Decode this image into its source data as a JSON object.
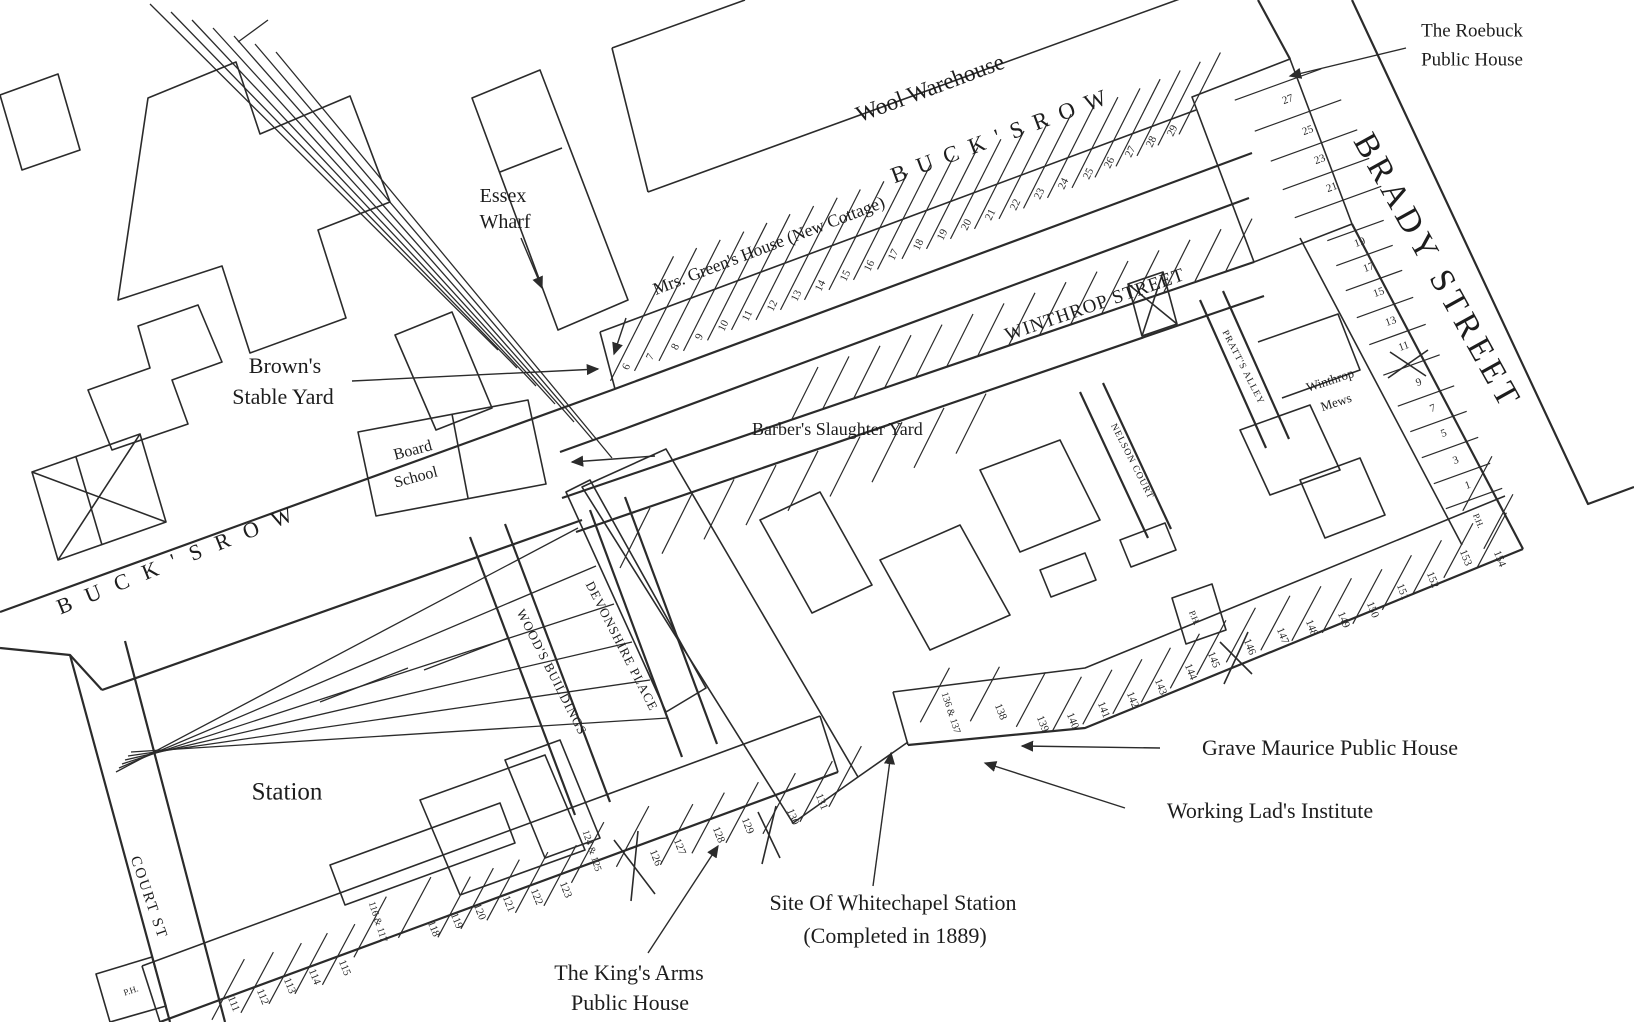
{
  "labels": {
    "wool_warehouse": "Wool Warehouse",
    "bucks_row_north": "B U C K ' S   R O W",
    "mrs_greens_house": "Mrs. Green's House (New Cottage)",
    "roebuck_line1": "The Roebuck",
    "roebuck_line2": "Public House",
    "brady_street": "BRADY STREET",
    "essex_wharf_line1": "Essex",
    "essex_wharf_line2": "Wharf",
    "browns_line1": "Brown's",
    "browns_line2": "Stable Yard",
    "board_school_line1": "Board",
    "board_school_line2": "School",
    "barbers_yard": "Barber's Slaughter Yard",
    "winthrop_street": "WINTHROP STREET",
    "pratts_alley": "PRATT'S ALLEY",
    "nelson_court": "NELSON COURT",
    "winthrop_mews_line1": "Winthrop",
    "winthrop_mews_line2": "Mews",
    "bucks_row_west": "B U C K ' S   R O W",
    "court_st": "COURT ST",
    "station": "Station",
    "woods_buildings": "WOOD'S BUILDINGS",
    "devonshire_place": "DEVONSHIRE PLACE",
    "grave_maurice": "Grave Maurice Public House",
    "working_lads": "Working Lad's Institute",
    "whitechapel_station_line1": "Site Of Whitechapel Station",
    "whitechapel_station_line2": "(Completed in 1889)",
    "kings_arms_line1": "The King's Arms",
    "kings_arms_line2": "Public House"
  },
  "house_numbers": [
    {
      "t": "6",
      "x": 627,
      "y": 367,
      "r": -64,
      "s": 11
    },
    {
      "t": "7",
      "x": 651,
      "y": 357,
      "r": -64,
      "s": 11
    },
    {
      "t": "8",
      "x": 676,
      "y": 347,
      "r": -64,
      "s": 11
    },
    {
      "t": "9",
      "x": 700,
      "y": 337,
      "r": -64,
      "s": 11
    },
    {
      "t": "10",
      "x": 724,
      "y": 326,
      "r": -64,
      "s": 11
    },
    {
      "t": "11",
      "x": 748,
      "y": 316,
      "r": -64,
      "s": 11
    },
    {
      "t": "12",
      "x": 773,
      "y": 306,
      "r": -64,
      "s": 11
    },
    {
      "t": "13",
      "x": 797,
      "y": 296,
      "r": -64,
      "s": 11
    },
    {
      "t": "14",
      "x": 821,
      "y": 286,
      "r": -64,
      "s": 11
    },
    {
      "t": "15",
      "x": 846,
      "y": 276,
      "r": -64,
      "s": 11
    },
    {
      "t": "16",
      "x": 870,
      "y": 266,
      "r": -64,
      "s": 11
    },
    {
      "t": "17",
      "x": 894,
      "y": 255,
      "r": -64,
      "s": 11
    },
    {
      "t": "18",
      "x": 919,
      "y": 245,
      "r": -64,
      "s": 11
    },
    {
      "t": "19",
      "x": 943,
      "y": 235,
      "r": -64,
      "s": 11
    },
    {
      "t": "20",
      "x": 967,
      "y": 225,
      "r": -64,
      "s": 11
    },
    {
      "t": "21",
      "x": 991,
      "y": 215,
      "r": -64,
      "s": 11
    },
    {
      "t": "22",
      "x": 1016,
      "y": 205,
      "r": -64,
      "s": 11
    },
    {
      "t": "23",
      "x": 1040,
      "y": 194,
      "r": -64,
      "s": 11
    },
    {
      "t": "24",
      "x": 1064,
      "y": 184,
      "r": -64,
      "s": 11
    },
    {
      "t": "25",
      "x": 1089,
      "y": 174,
      "r": -64,
      "s": 11
    },
    {
      "t": "26",
      "x": 1110,
      "y": 163,
      "r": -64,
      "s": 11
    },
    {
      "t": "27",
      "x": 1131,
      "y": 152,
      "r": -64,
      "s": 11
    },
    {
      "t": "28",
      "x": 1152,
      "y": 142,
      "r": -64,
      "s": 11
    },
    {
      "t": "29",
      "x": 1173,
      "y": 131,
      "r": -64,
      "s": 11
    },
    {
      "t": "27",
      "x": 1288,
      "y": 100,
      "r": -20,
      "s": 11
    },
    {
      "t": "25",
      "x": 1308,
      "y": 131,
      "r": -20,
      "s": 11
    },
    {
      "t": "23",
      "x": 1320,
      "y": 160,
      "r": -20,
      "s": 11
    },
    {
      "t": "21",
      "x": 1332,
      "y": 188,
      "r": -20,
      "s": 11
    },
    {
      "t": "19",
      "x": 1360,
      "y": 243,
      "r": -20,
      "s": 11
    },
    {
      "t": "17",
      "x": 1369,
      "y": 268,
      "r": -20,
      "s": 11
    },
    {
      "t": "15",
      "x": 1379,
      "y": 293,
      "r": -20,
      "s": 11
    },
    {
      "t": "13",
      "x": 1391,
      "y": 322,
      "r": -20,
      "s": 11
    },
    {
      "t": "11",
      "x": 1404,
      "y": 347,
      "r": -20,
      "s": 11
    },
    {
      "t": "9",
      "x": 1419,
      "y": 383,
      "r": -20,
      "s": 11
    },
    {
      "t": "7",
      "x": 1433,
      "y": 409,
      "r": -20,
      "s": 11
    },
    {
      "t": "5",
      "x": 1444,
      "y": 434,
      "r": -20,
      "s": 11
    },
    {
      "t": "3",
      "x": 1456,
      "y": 461,
      "r": -20,
      "s": 11
    },
    {
      "t": "1",
      "x": 1468,
      "y": 486,
      "r": -20,
      "s": 11
    },
    {
      "t": "P.H.",
      "x": 1478,
      "y": 521,
      "r": 68,
      "s": 9
    },
    {
      "t": "154",
      "x": 1499,
      "y": 559,
      "r": 68,
      "s": 11
    },
    {
      "t": "153",
      "x": 1465,
      "y": 558,
      "r": 68,
      "s": 11
    },
    {
      "t": "152",
      "x": 1432,
      "y": 580,
      "r": 68,
      "s": 11
    },
    {
      "t": "151",
      "x": 1402,
      "y": 592,
      "r": 68,
      "s": 11
    },
    {
      "t": "150",
      "x": 1372,
      "y": 610,
      "r": 68,
      "s": 11
    },
    {
      "t": "149",
      "x": 1343,
      "y": 620,
      "r": 68,
      "s": 11
    },
    {
      "t": "148",
      "x": 1311,
      "y": 628,
      "r": 68,
      "s": 11
    },
    {
      "t": "147",
      "x": 1282,
      "y": 636,
      "r": 68,
      "s": 11
    },
    {
      "t": "146",
      "x": 1249,
      "y": 647,
      "r": 68,
      "s": 11
    },
    {
      "t": "145",
      "x": 1213,
      "y": 660,
      "r": 68,
      "s": 11
    },
    {
      "t": "144",
      "x": 1190,
      "y": 672,
      "r": 68,
      "s": 11
    },
    {
      "t": "143",
      "x": 1160,
      "y": 687,
      "r": 68,
      "s": 11
    },
    {
      "t": "142",
      "x": 1132,
      "y": 700,
      "r": 68,
      "s": 11
    },
    {
      "t": "141",
      "x": 1103,
      "y": 710,
      "r": 68,
      "s": 11
    },
    {
      "t": "140",
      "x": 1072,
      "y": 721,
      "r": 68,
      "s": 11
    },
    {
      "t": "139",
      "x": 1042,
      "y": 724,
      "r": 68,
      "s": 11
    },
    {
      "t": "138",
      "x": 1000,
      "y": 712,
      "r": 68,
      "s": 11
    },
    {
      "t": "136 & 137",
      "x": 950,
      "y": 713,
      "r": 72,
      "s": 10
    },
    {
      "t": "P.H.",
      "x": 1194,
      "y": 618,
      "r": 68,
      "s": 9
    },
    {
      "t": "111",
      "x": 233,
      "y": 1004,
      "r": 68,
      "s": 11
    },
    {
      "t": "112",
      "x": 262,
      "y": 997,
      "r": 68,
      "s": 11
    },
    {
      "t": "113",
      "x": 289,
      "y": 986,
      "r": 68,
      "s": 11
    },
    {
      "t": "114",
      "x": 314,
      "y": 977,
      "r": 68,
      "s": 11
    },
    {
      "t": "115",
      "x": 344,
      "y": 968,
      "r": 68,
      "s": 11
    },
    {
      "t": "116 & 117",
      "x": 377,
      "y": 922,
      "r": 72,
      "s": 10
    },
    {
      "t": "118",
      "x": 433,
      "y": 929,
      "r": 68,
      "s": 11
    },
    {
      "t": "119",
      "x": 456,
      "y": 921,
      "r": 68,
      "s": 11
    },
    {
      "t": "120",
      "x": 479,
      "y": 912,
      "r": 68,
      "s": 11
    },
    {
      "t": "121",
      "x": 508,
      "y": 904,
      "r": 68,
      "s": 11
    },
    {
      "t": "122",
      "x": 536,
      "y": 897,
      "r": 68,
      "s": 11
    },
    {
      "t": "123",
      "x": 565,
      "y": 890,
      "r": 68,
      "s": 11
    },
    {
      "t": "124 & 125",
      "x": 591,
      "y": 851,
      "r": 72,
      "s": 10
    },
    {
      "t": "126",
      "x": 655,
      "y": 858,
      "r": 68,
      "s": 11
    },
    {
      "t": "127",
      "x": 679,
      "y": 847,
      "r": 68,
      "s": 11
    },
    {
      "t": "128",
      "x": 718,
      "y": 835,
      "r": 68,
      "s": 11
    },
    {
      "t": "129",
      "x": 747,
      "y": 826,
      "r": 68,
      "s": 11
    },
    {
      "t": "130",
      "x": 792,
      "y": 817,
      "r": 68,
      "s": 11
    },
    {
      "t": "131",
      "x": 821,
      "y": 802,
      "r": 68,
      "s": 11
    },
    {
      "t": "P.H.",
      "x": 131,
      "y": 991,
      "r": -18,
      "s": 9
    }
  ],
  "ink_color": "#2b2b2b"
}
